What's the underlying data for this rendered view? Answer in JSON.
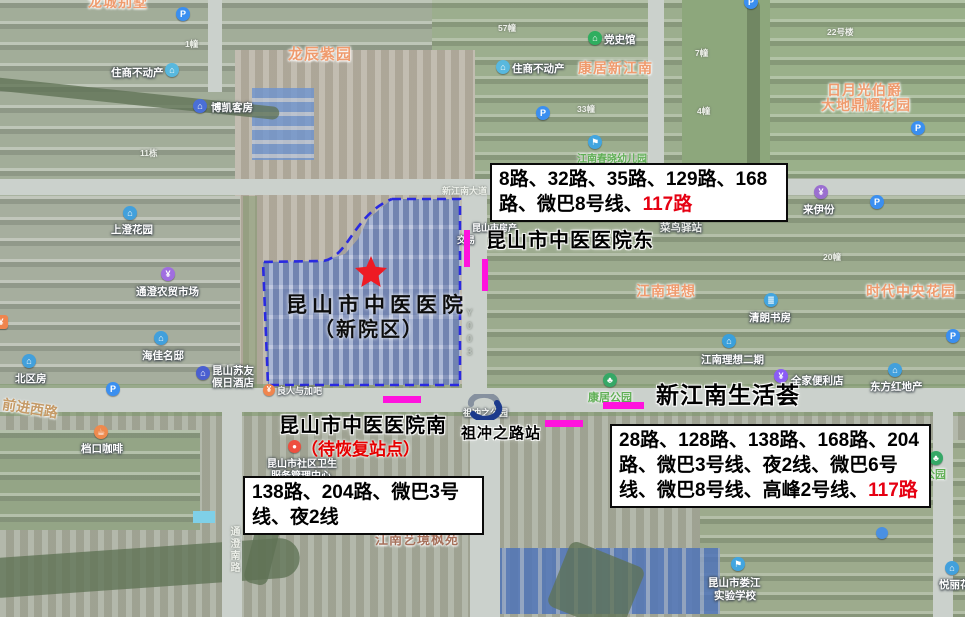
{
  "annotations": {
    "east_stop": {
      "title": "昆山市中医医院东",
      "routes": "8路、32路、35路、129路、168路、微巴8号线、",
      "routes_red": "117路"
    },
    "south_stop": {
      "title": "昆山市中医医院南",
      "status": "（待恢复站点）",
      "routes": "138路、204路、微巴3号线、夜2线"
    },
    "shenghuo_stop": {
      "title": "新江南生活荟",
      "routes": "28路、128路、138路、168路、204路、微巴3号线、夜2线、微巴6号线、微巴8号线、高峰2号线、",
      "routes_red": "117路"
    },
    "hospital": {
      "line1": "昆山市中医医院",
      "line2": "（新院区）"
    },
    "metro_station": {
      "name": "祖冲之路站",
      "park_label": "祖冲之公园"
    }
  },
  "labels": {
    "top_cut": "龙城别墅",
    "longchen": "龙辰紫园",
    "zhushang_1": "住商不动产",
    "bokai": "博凯客房",
    "dangshiguan": "党史馆",
    "kangju_xjn": "康居新江南",
    "zhushang_2": "住商不动产",
    "riyueguang_1": "日月光伯爵",
    "riyueguang_2": "大地鼎耀花园",
    "laiyifen": "来伊份",
    "shangcheng": "上澄花园",
    "tongcheng_sc": "通澄农贸市场",
    "cainiao": "菜鸟驿站",
    "chunxiao": "江南春晓幼儿园",
    "jn_lixiang": "江南理想",
    "shidai": "时代中央花园",
    "qinglang": "清朗书房",
    "jn_lixiang2": "江南理想二期",
    "quanjia": "全家便利店",
    "dongfanghong": "东方红地产",
    "kangju_gy": "康居公园",
    "gongyuan": "公园",
    "haijia": "海佳名邸",
    "beiqufang": "北区房",
    "suyou_1": "昆山苏友",
    "suyou_2": "假日酒店",
    "dangkou": "档口咖啡",
    "fangchan_1": "昆山市房产",
    "fangchan_2": "交易",
    "shequ_1": "昆山市社区卫生",
    "shequ_2": "服务管理中心",
    "lurenjia": "良人与加吧",
    "jn_yijing": "江南艺境枫苑",
    "louxiao_1": "昆山市娄江",
    "louxiao_2": "实验学校",
    "yueli": "悦丽花园",
    "qianjin_xilu": "前进西路",
    "y003": "Y003",
    "tongcheng_nanlu": "通澄南路",
    "xjn_dadao": "新江南大道",
    "bld_1": "1幢",
    "bld_57": "57幢",
    "bld_7": "7幢",
    "bld_4": "4幢",
    "bld_33": "33幢",
    "bld_20": "20幢",
    "bld_22": "22号楼",
    "bld_11": "11栋"
  },
  "icons": {
    "parking": "P",
    "landmark": "⌂",
    "shop": "¥",
    "park": "♣",
    "flag": "⚑",
    "book": "≣",
    "coffee": "☕",
    "dot": "●"
  },
  "colors": {
    "highlight_magenta": "#ff12dd",
    "route_red": "#e60012",
    "boundary_blue": "#2a2ae0",
    "star_red": "#ee1b24"
  }
}
